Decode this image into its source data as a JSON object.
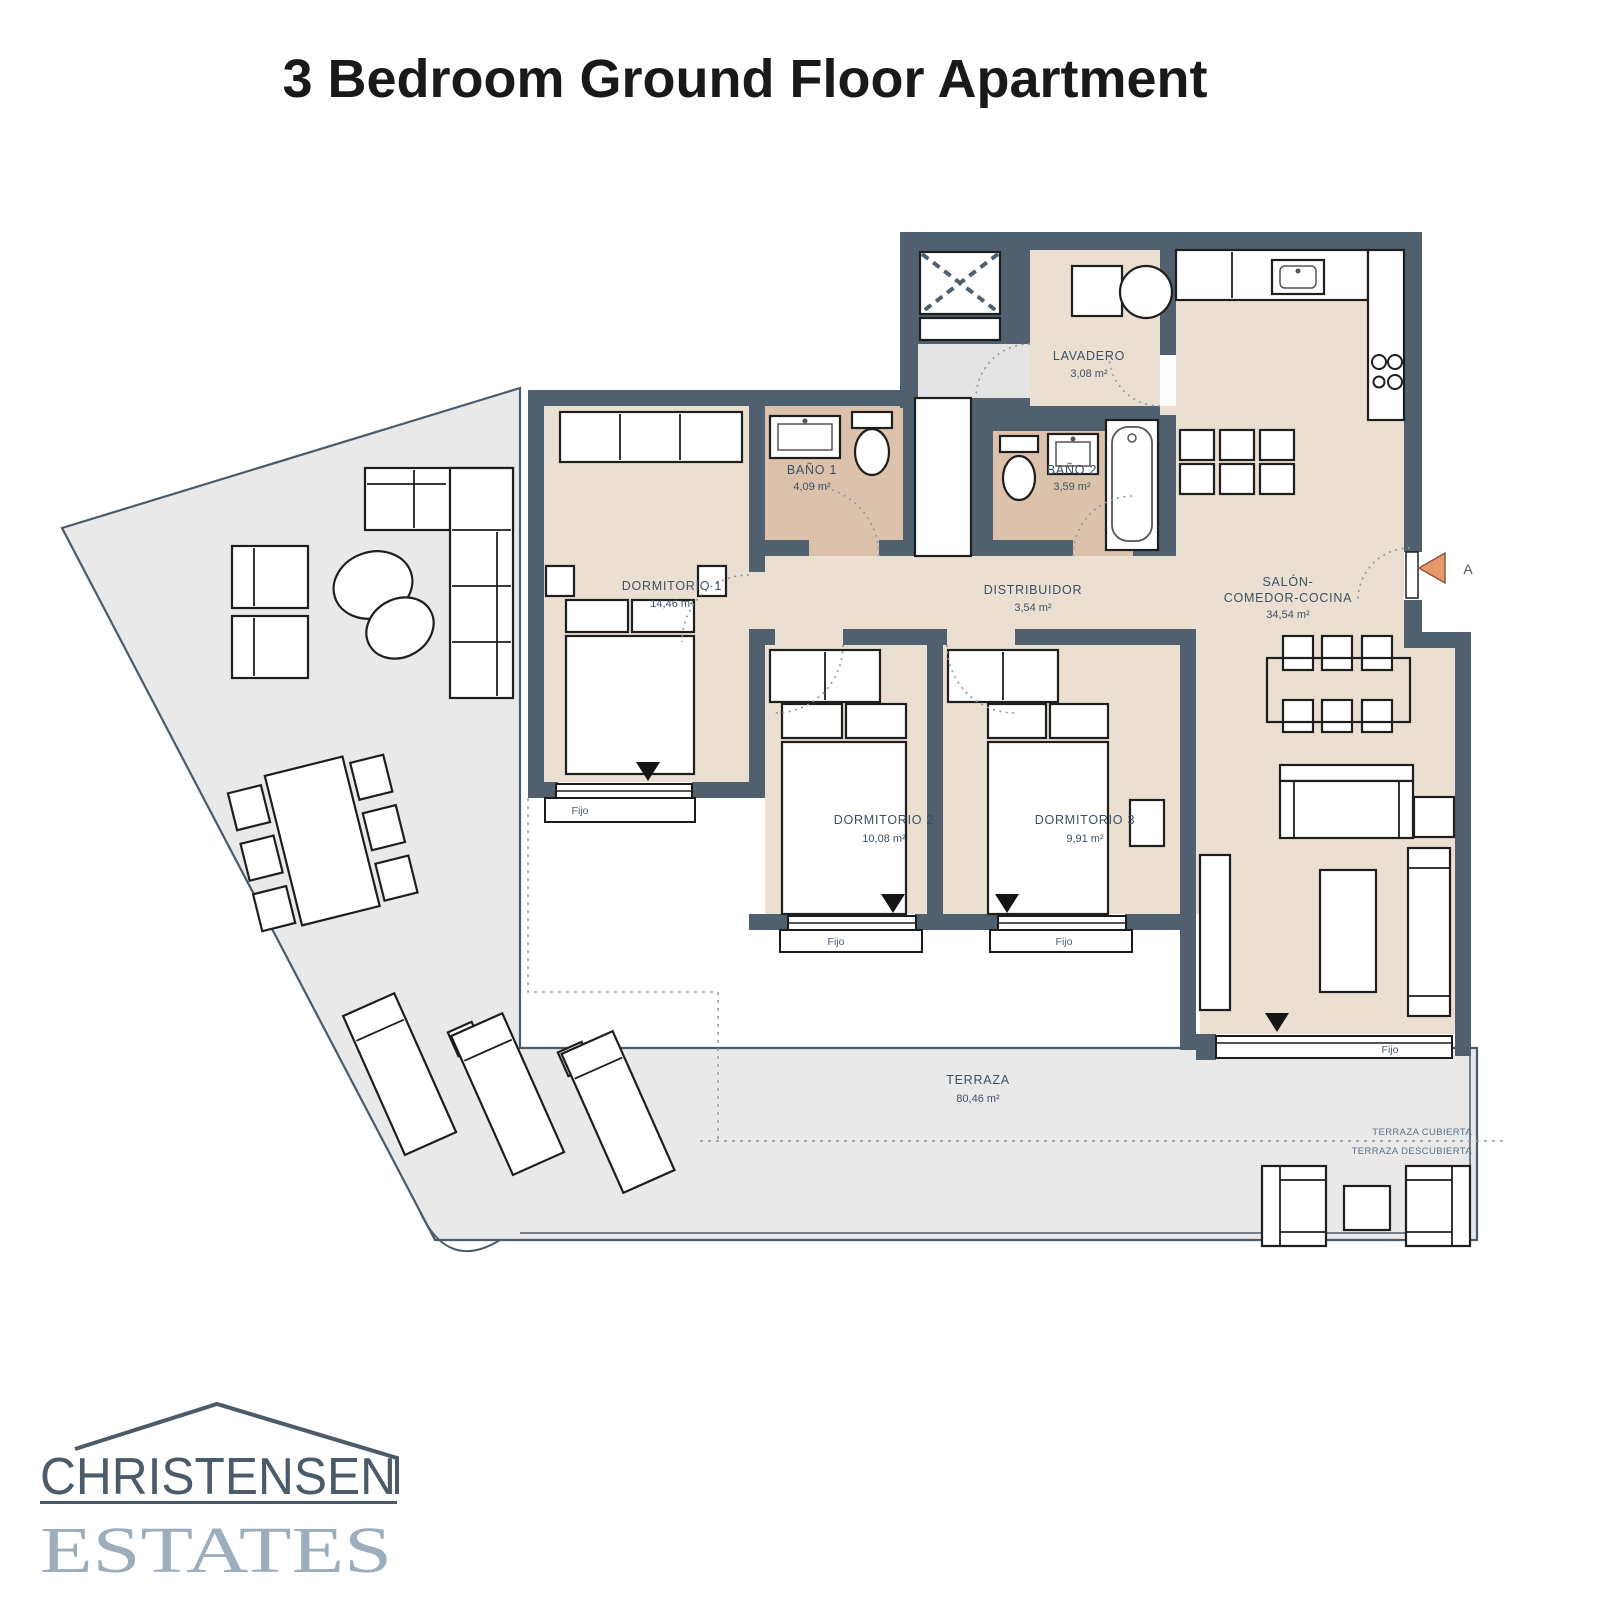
{
  "title": "3 Bedroom Ground Floor Apartment",
  "colors": {
    "wall": "#51606e",
    "floor": "#ebdfd2",
    "bathroom_floor": "#dcc2aa",
    "terrace": "#e9e9e9",
    "label_text": "#3d4f63",
    "entrance_arrow": "#e8996b",
    "logo_dark": "#4b5b69",
    "logo_light": "#9cadbb"
  },
  "plan": {
    "rooms": {
      "dormitorio1": {
        "name": "DORMITORIO 1",
        "area": "14,46 m²"
      },
      "bano1": {
        "name": "BAÑO 1",
        "area": "4,09 m²"
      },
      "bano2": {
        "name": "BAÑO 2",
        "area": "3,59 m²"
      },
      "lavadero": {
        "name": "LAVADERO",
        "area": "3,08 m²"
      },
      "distribuidor": {
        "name": "DISTRIBUIDOR",
        "area": "3,54 m²"
      },
      "salon": {
        "name_line1": "SALÓN-",
        "name_line2": "COMEDOR-COCINA",
        "area": "34,54 m²"
      },
      "dormitorio2": {
        "name": "DORMITORIO 2",
        "area": "10,08 m²"
      },
      "dormitorio3": {
        "name": "DORMITORIO 3",
        "area": "9,91 m²"
      },
      "terraza": {
        "name": "TERRAZA",
        "area": "80,46 m²"
      }
    },
    "window_label": "Fijo",
    "terrace_covered_label": "TERRAZA CUBIERTA",
    "terrace_uncovered_label": "TERRAZA DESCUBIERTA",
    "section_marker": "A"
  },
  "logo": {
    "top": "CHRISTENSEN",
    "bottom": "ESTATES"
  }
}
